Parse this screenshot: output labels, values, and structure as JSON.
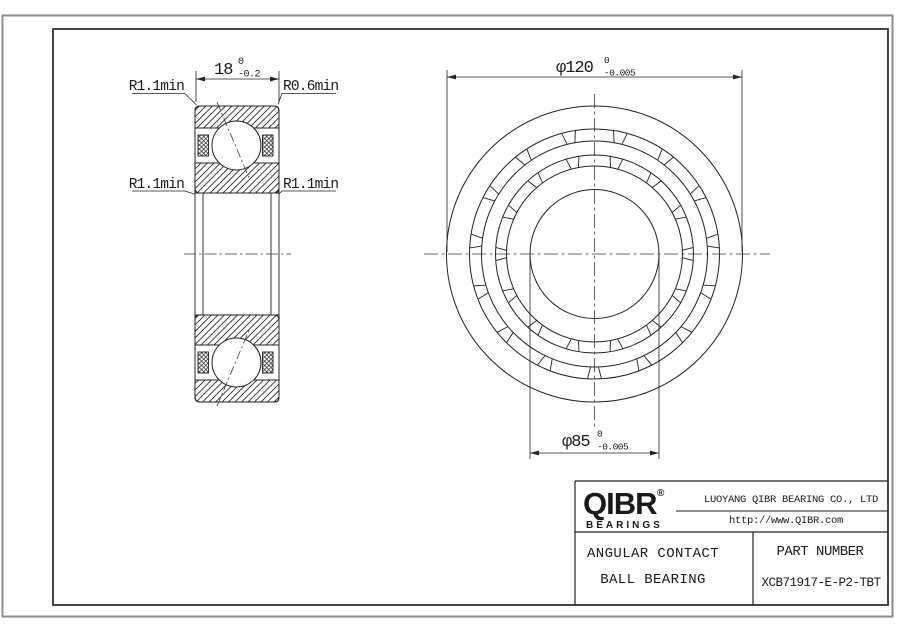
{
  "colors": {
    "line": "#222222",
    "centerline": "#3a3a3a",
    "sheet_border": "#8c8c8c"
  },
  "section_view": {
    "width_dim": {
      "value": "18",
      "tol_upper": "0",
      "tol_lower": "-0.2"
    },
    "radius_labels": {
      "top_left": "R1.1min",
      "top_right": "R0.6min",
      "mid_left": "R1.1min",
      "mid_right": "R1.1min"
    }
  },
  "front_view": {
    "outer_dim": {
      "value": "φ120",
      "tol_upper": "0",
      "tol_lower": "-0.005"
    },
    "bore_dim": {
      "value": "φ85",
      "tol_upper": "0",
      "tol_lower": "-0.005"
    }
  },
  "title_block": {
    "brand": "QIBR",
    "brand_registered": "®",
    "brand_subtitle": "BEARINGS",
    "company": "LUOYANG QIBR BEARING CO., LTD",
    "website": "http://www.QIBR.com",
    "product_line1": "ANGULAR CONTACT",
    "product_line2": "BALL BEARING",
    "part_number_label": "PART NUMBER",
    "part_number": "XCB71917-E-P2-TBT"
  }
}
